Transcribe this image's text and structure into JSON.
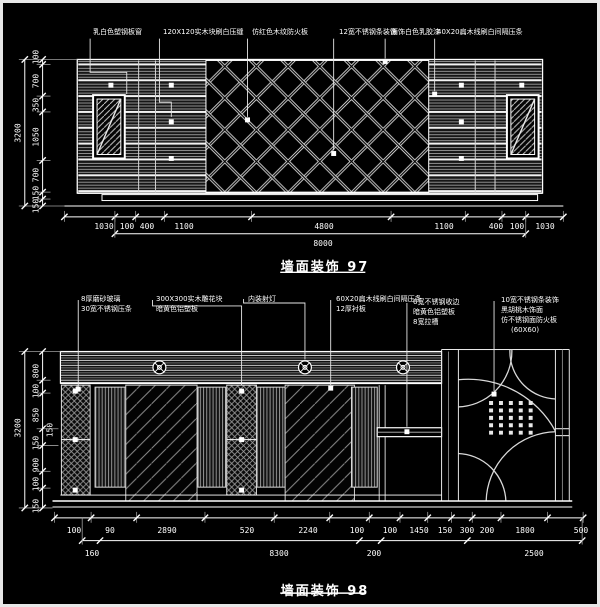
{
  "canvas": {
    "background": "#000000",
    "line_color": "#ffffff",
    "border_color": "#e8e8e8"
  },
  "drawing97": {
    "title": "墙面装饰 97",
    "labels": [
      "乳白色塑钢板窗",
      "120X120实木块刷白压缝",
      "仿红色木纹防火板",
      "12宽不锈钢条装饰",
      "面饰白色乳胶漆",
      "40X20扁木线刷白间隔压条"
    ],
    "dims_left": [
      "100",
      "700",
      "350",
      "1050",
      "700",
      "150",
      "150"
    ],
    "dims_left_total": "3200",
    "dims_bottom": [
      "1030",
      "100",
      "400",
      "1100",
      "4800",
      "1100",
      "400",
      "100",
      "1030"
    ],
    "dims_bottom_total": "8000"
  },
  "drawing98": {
    "title": "墙面装饰 98",
    "label_groups": [
      {
        "lines": [
          "8厚磨砂玻璃",
          "30宽不锈钢压条"
        ]
      },
      {
        "lines": [
          "300X300实木雕花块",
          "暗黄色铝塑板"
        ]
      },
      {
        "lines": [
          "内装射灯"
        ]
      },
      {
        "lines": [
          "60X20扁木线刷白间隔压条",
          "12厚衬板"
        ]
      },
      {
        "lines": [
          "6宽不锈钢收边",
          "暗黄色铝塑板",
          "8宽拉槽"
        ]
      },
      {
        "lines": [
          "10宽不锈钢条装饰",
          "黑胡桃木饰面",
          "仿不锈钢面防火板",
          "(60X60)"
        ]
      }
    ],
    "dims_left": [
      "800",
      "100",
      "850",
      "150",
      "150",
      "900",
      "100",
      "150"
    ],
    "dims_left_total": "3200",
    "dims_bottom_row1": [
      "100",
      "90",
      "2890",
      "520",
      "2240",
      "100",
      "100",
      "1450",
      "150",
      "300",
      "200",
      "1800",
      "500"
    ],
    "dims_bottom_row2": [
      "160",
      "8300",
      "200",
      "2500"
    ],
    "spotlight_count": 3
  }
}
